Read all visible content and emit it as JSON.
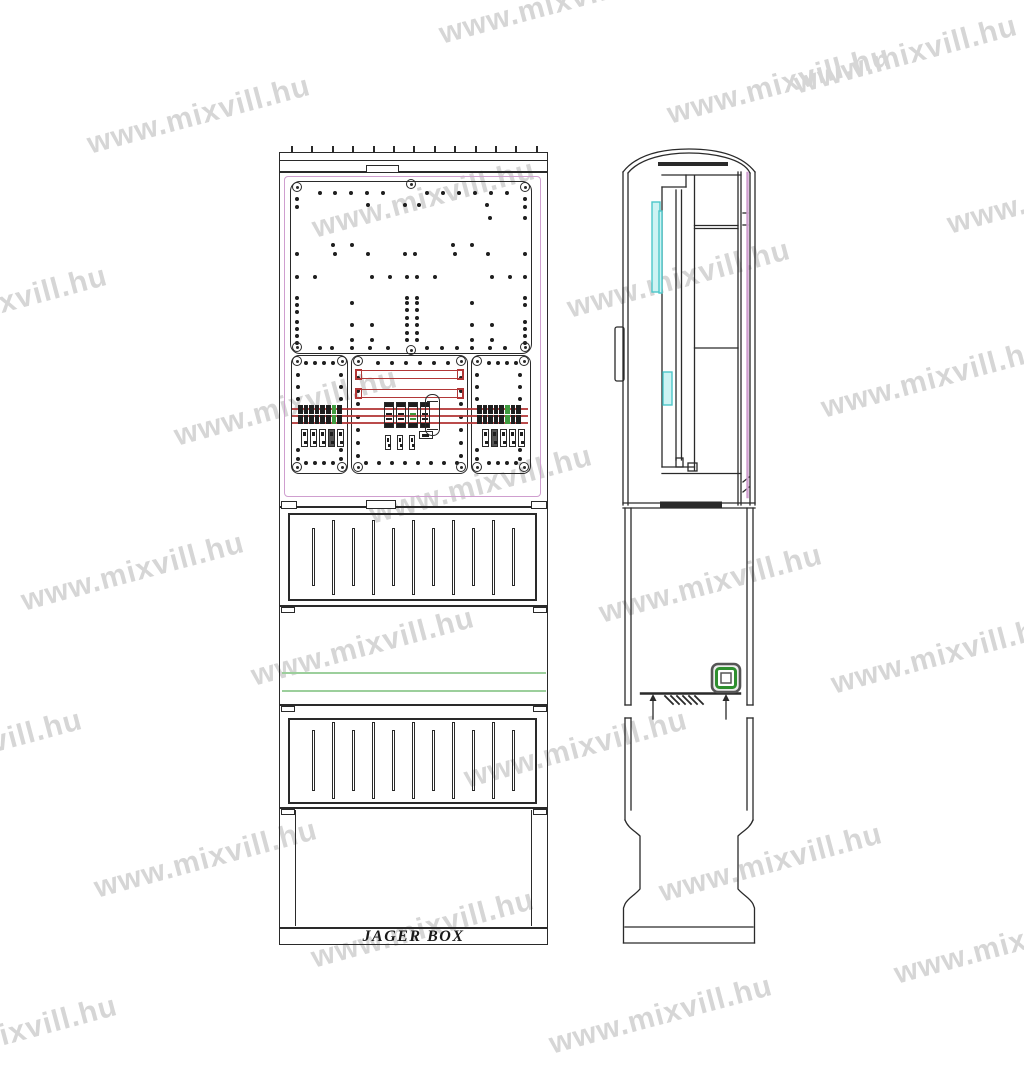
{
  "title": "JAGER BOX technical drawing",
  "watermark": {
    "text": "www.mixvill.hu",
    "color": "#d6d6d6",
    "angle_deg": -15,
    "positions": [
      [
        88,
        128
      ],
      [
        440,
        18
      ],
      [
        795,
        68
      ],
      [
        668,
        98
      ],
      [
        948,
        208
      ],
      [
        -115,
        318
      ],
      [
        313,
        212
      ],
      [
        175,
        420
      ],
      [
        822,
        392
      ],
      [
        22,
        585
      ],
      [
        600,
        597
      ],
      [
        832,
        668
      ],
      [
        -140,
        762
      ],
      [
        252,
        660
      ],
      [
        465,
        762
      ],
      [
        95,
        872
      ],
      [
        660,
        876
      ],
      [
        312,
        942
      ],
      [
        -105,
        1048
      ],
      [
        550,
        1028
      ],
      [
        895,
        958
      ],
      [
        370,
        498
      ],
      [
        568,
        292
      ]
    ]
  },
  "colors": {
    "line": "#2a2a2a",
    "pink": "#cf9ecf",
    "red": "#b23737",
    "cyan_border": "#4cc6c9",
    "cyan_fill": "#cdf3f3",
    "green_line": "#9ccf9c",
    "green_accent": "#3f9b3f",
    "lock_green": "#2f8f2f",
    "dark_fill": "#1e1e1e",
    "wm": "#d6d6d6"
  },
  "front": {
    "label": "JAGER BOX",
    "roof_ticks": {
      "y": 146,
      "x0": 291,
      "step": 20.4,
      "count": 13
    },
    "dots": [
      [
        320,
        193
      ],
      [
        335,
        193
      ],
      [
        351,
        193
      ],
      [
        367,
        193
      ],
      [
        383,
        193
      ],
      [
        427,
        193
      ],
      [
        443,
        193
      ],
      [
        459,
        193
      ],
      [
        475,
        193
      ],
      [
        491,
        193
      ],
      [
        507,
        193
      ],
      [
        368,
        205
      ],
      [
        405,
        205
      ],
      [
        419,
        205
      ],
      [
        487,
        205
      ],
      [
        490,
        218
      ],
      [
        297,
        199
      ],
      [
        297,
        207
      ],
      [
        297,
        254
      ],
      [
        297,
        277
      ],
      [
        297,
        298
      ],
      [
        297,
        305
      ],
      [
        297,
        312
      ],
      [
        297,
        322
      ],
      [
        297,
        329
      ],
      [
        297,
        336
      ],
      [
        297,
        343
      ],
      [
        525,
        199
      ],
      [
        525,
        207
      ],
      [
        525,
        218
      ],
      [
        525,
        254
      ],
      [
        525,
        277
      ],
      [
        525,
        298
      ],
      [
        525,
        305
      ],
      [
        525,
        322
      ],
      [
        525,
        329
      ],
      [
        525,
        336
      ],
      [
        525,
        343
      ],
      [
        333,
        245
      ],
      [
        352,
        245
      ],
      [
        453,
        245
      ],
      [
        472,
        245
      ],
      [
        335,
        254
      ],
      [
        368,
        254
      ],
      [
        405,
        254
      ],
      [
        415,
        254
      ],
      [
        455,
        254
      ],
      [
        488,
        254
      ],
      [
        315,
        277
      ],
      [
        372,
        277
      ],
      [
        390,
        277
      ],
      [
        407,
        277
      ],
      [
        417,
        277
      ],
      [
        435,
        277
      ],
      [
        492,
        277
      ],
      [
        510,
        277
      ],
      [
        407,
        298
      ],
      [
        417,
        298
      ],
      [
        352,
        303
      ],
      [
        407,
        303
      ],
      [
        417,
        303
      ],
      [
        472,
        303
      ],
      [
        407,
        310
      ],
      [
        417,
        310
      ],
      [
        407,
        318
      ],
      [
        417,
        318
      ],
      [
        352,
        325
      ],
      [
        372,
        325
      ],
      [
        407,
        325
      ],
      [
        417,
        325
      ],
      [
        472,
        325
      ],
      [
        492,
        325
      ],
      [
        407,
        333
      ],
      [
        417,
        333
      ],
      [
        352,
        340
      ],
      [
        372,
        340
      ],
      [
        407,
        340
      ],
      [
        417,
        340
      ],
      [
        472,
        340
      ],
      [
        492,
        340
      ],
      [
        320,
        348
      ],
      [
        332,
        348
      ],
      [
        352,
        348
      ],
      [
        370,
        348
      ],
      [
        388,
        348
      ],
      [
        427,
        348
      ],
      [
        442,
        348
      ],
      [
        457,
        348
      ],
      [
        472,
        348
      ],
      [
        490,
        348
      ],
      [
        505,
        348
      ],
      [
        306,
        363
      ],
      [
        315,
        363
      ],
      [
        324,
        363
      ],
      [
        333,
        363
      ],
      [
        306,
        463
      ],
      [
        315,
        463
      ],
      [
        324,
        463
      ],
      [
        333,
        463
      ],
      [
        298,
        375
      ],
      [
        298,
        387
      ],
      [
        298,
        399
      ],
      [
        298,
        450
      ],
      [
        298,
        459
      ],
      [
        341,
        375
      ],
      [
        341,
        387
      ],
      [
        341,
        399
      ],
      [
        341,
        450
      ],
      [
        341,
        459
      ],
      [
        378,
        363
      ],
      [
        392,
        363
      ],
      [
        406,
        363
      ],
      [
        420,
        363
      ],
      [
        434,
        363
      ],
      [
        448,
        363
      ],
      [
        366,
        463
      ],
      [
        379,
        463
      ],
      [
        392,
        463
      ],
      [
        405,
        463
      ],
      [
        418,
        463
      ],
      [
        431,
        463
      ],
      [
        444,
        463
      ],
      [
        457,
        463
      ],
      [
        358,
        378
      ],
      [
        358,
        391
      ],
      [
        358,
        404
      ],
      [
        358,
        417
      ],
      [
        358,
        430
      ],
      [
        358,
        443
      ],
      [
        358,
        456
      ],
      [
        461,
        378
      ],
      [
        461,
        391
      ],
      [
        461,
        404
      ],
      [
        461,
        417
      ],
      [
        461,
        430
      ],
      [
        461,
        443
      ],
      [
        461,
        456
      ],
      [
        489,
        363
      ],
      [
        498,
        363
      ],
      [
        507,
        363
      ],
      [
        516,
        363
      ],
      [
        489,
        463
      ],
      [
        498,
        463
      ],
      [
        507,
        463
      ],
      [
        516,
        463
      ],
      [
        477,
        375
      ],
      [
        477,
        387
      ],
      [
        477,
        399
      ],
      [
        477,
        450
      ],
      [
        477,
        459
      ],
      [
        520,
        375
      ],
      [
        520,
        387
      ],
      [
        520,
        399
      ],
      [
        520,
        450
      ],
      [
        520,
        459
      ]
    ],
    "screws": [
      [
        297,
        187
      ],
      [
        411,
        184
      ],
      [
        525,
        187
      ],
      [
        297,
        347
      ],
      [
        411,
        350
      ],
      [
        525,
        347
      ],
      [
        297,
        361
      ],
      [
        342,
        361
      ],
      [
        297,
        467
      ],
      [
        342,
        467
      ],
      [
        358,
        361
      ],
      [
        461,
        361
      ],
      [
        358,
        467
      ],
      [
        461,
        467
      ],
      [
        477,
        361
      ],
      [
        524,
        361
      ],
      [
        477,
        467
      ],
      [
        524,
        467
      ]
    ],
    "vents": [
      {
        "x0": 312,
        "step": 20,
        "count": 11,
        "long_y": 520,
        "long_h": 75,
        "short_y": 528,
        "short_h": 58
      },
      {
        "x0": 312,
        "step": 20,
        "count": 11,
        "long_y": 722,
        "long_h": 77,
        "short_y": 730,
        "short_h": 61
      }
    ],
    "busbars": {
      "ys": [
        408,
        415,
        422
      ],
      "x": 292,
      "w": 236
    },
    "red_frames": [
      {
        "x": 356,
        "y": 370,
        "w": 107,
        "h": 9
      },
      {
        "x": 356,
        "y": 389,
        "w": 107,
        "h": 9
      }
    ],
    "green_lines": {
      "ys": [
        672,
        690
      ],
      "x": 282,
      "w": 264
    },
    "blocks": [
      {
        "x": 298,
        "y": 405,
        "cols": 8,
        "green": 6
      },
      {
        "x": 477,
        "y": 405,
        "cols": 8,
        "green": 5
      }
    ],
    "modules": {
      "xs": [
        384,
        396,
        408,
        420
      ],
      "y": 402,
      "w": 10,
      "h": 26,
      "green": 2
    },
    "barrel": {
      "x": 425,
      "y": 394,
      "w": 15,
      "h": 42
    },
    "fuses": [
      {
        "xs": [
          301,
          310,
          319,
          328,
          337
        ],
        "y": 429,
        "w": 7,
        "h": 18,
        "dark": 3
      },
      {
        "xs": [
          482,
          491,
          500,
          509,
          518
        ],
        "y": 429,
        "w": 7,
        "h": 18,
        "dark": 1
      },
      {
        "xs": [
          385,
          397,
          409
        ],
        "y": 435,
        "w": 6,
        "h": 15,
        "dark": -1
      }
    ],
    "wide_box": {
      "x": 419,
      "y": 431,
      "w": 14,
      "h": 8
    }
  }
}
